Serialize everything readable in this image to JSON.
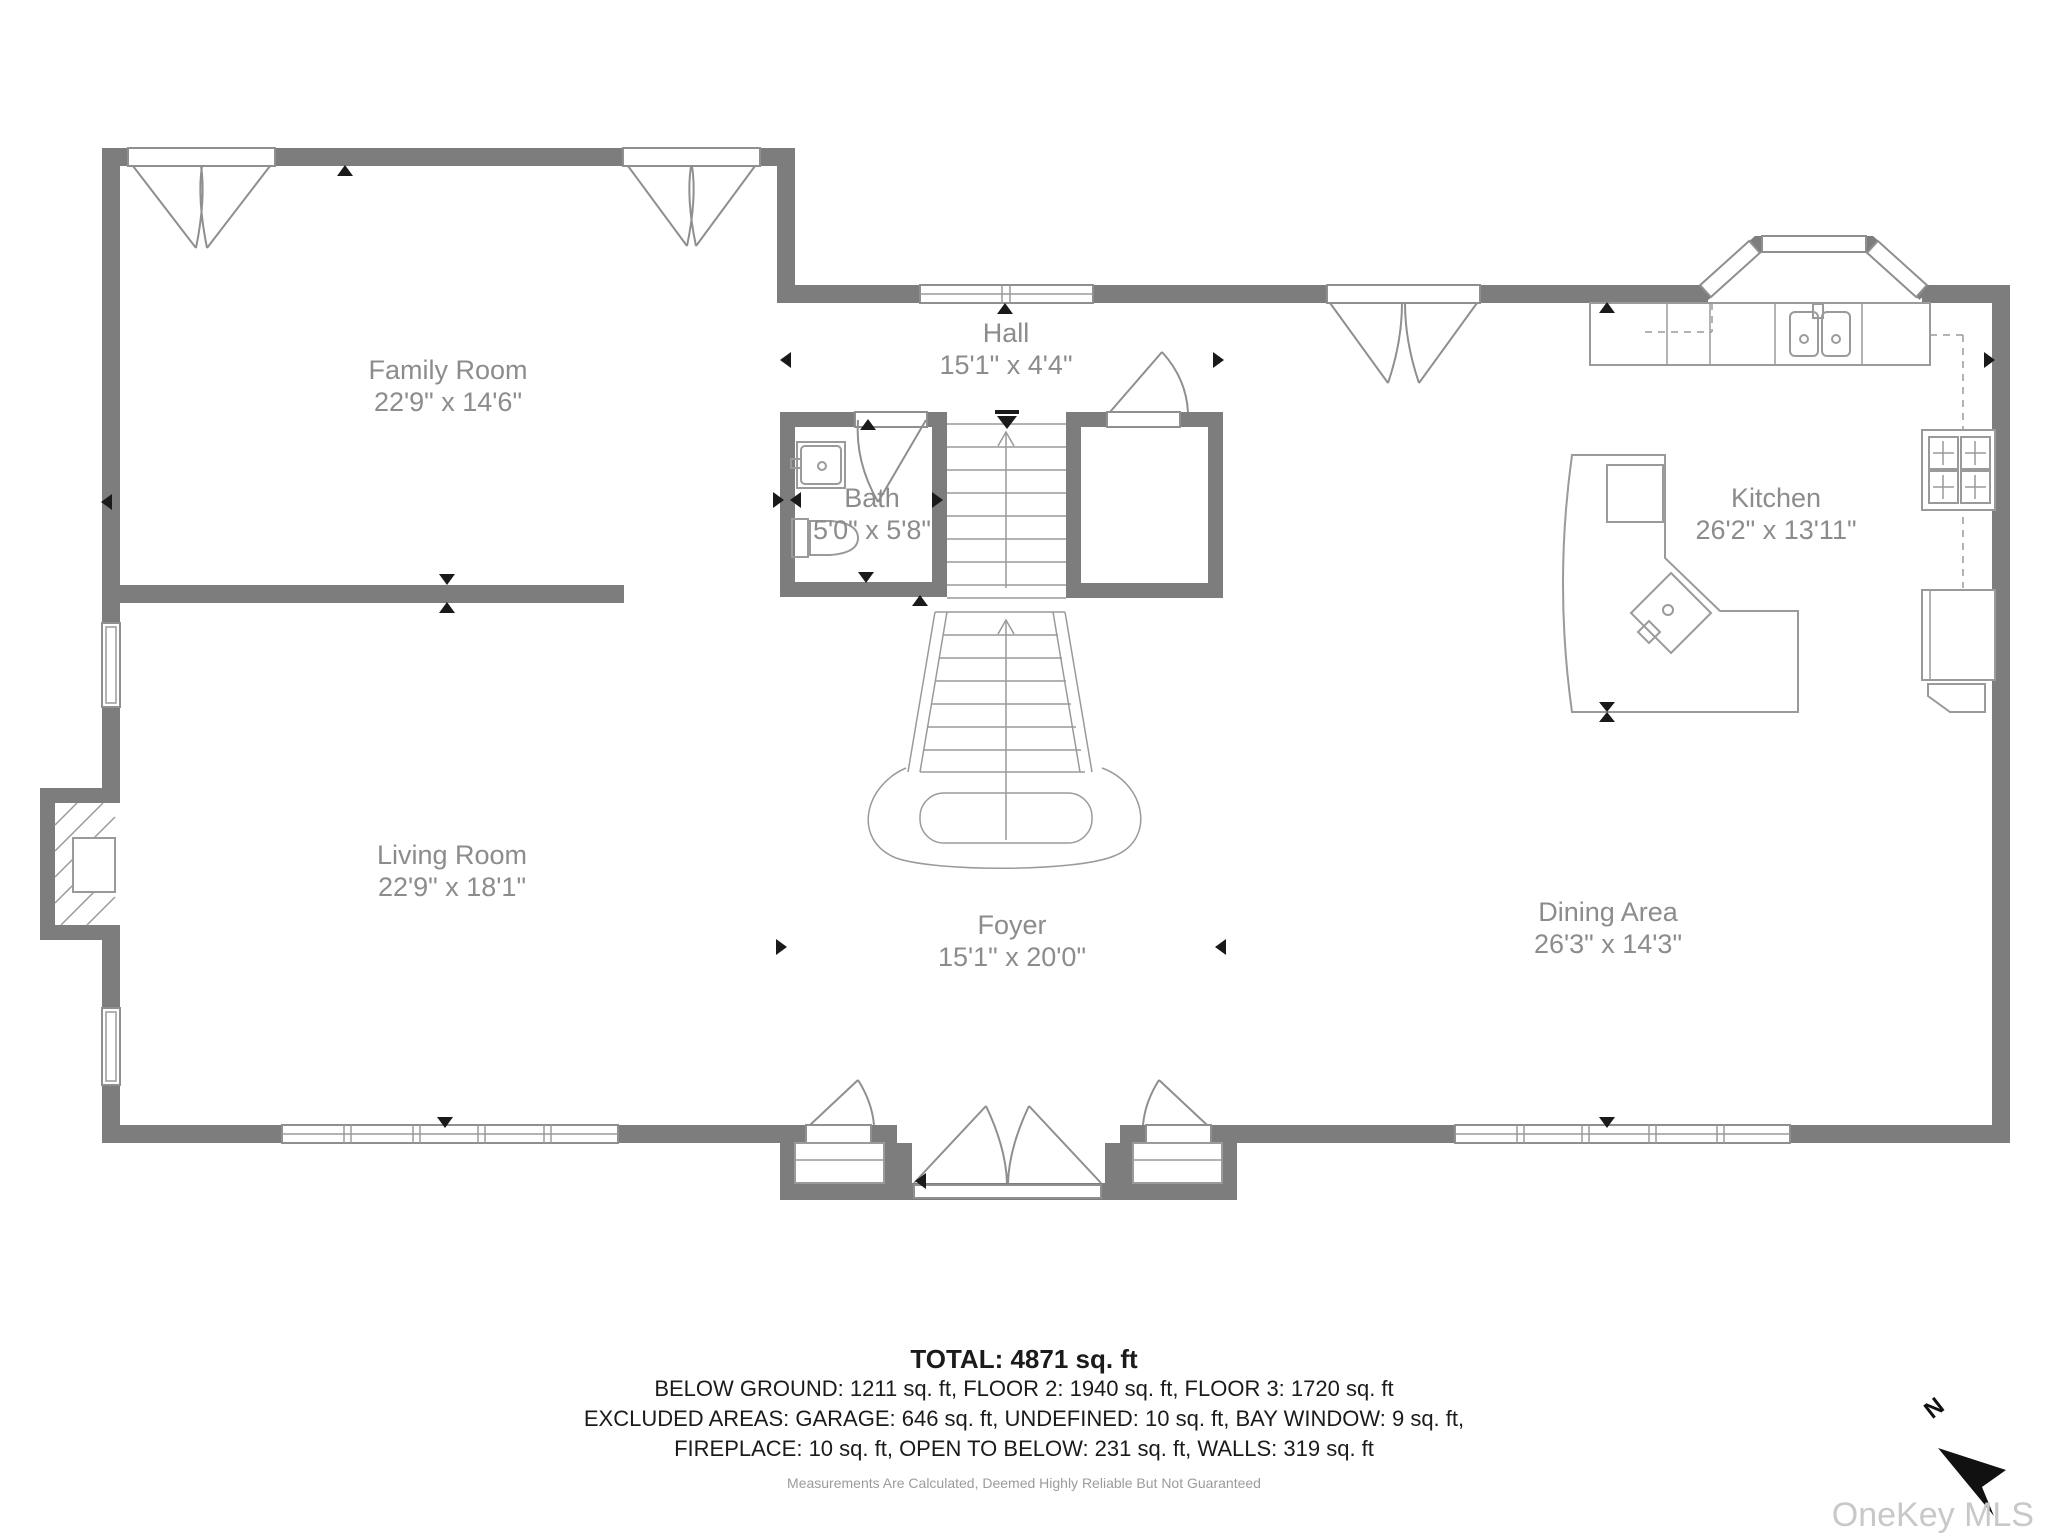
{
  "title": "First floor plan",
  "colors": {
    "wall": "#7d7d7d",
    "fixture_line": "#9a9a9a",
    "room_label": "#8c8c8c",
    "summary_text": "#1b1b1b",
    "note_text": "#9b9b9b",
    "watermark": "#c8c8c8",
    "marker": "#1a1a1a"
  },
  "rooms": [
    {
      "id": "family-room",
      "name": "Family Room",
      "dims": "22'9\" x 14'6\""
    },
    {
      "id": "hall",
      "name": "Hall",
      "dims": "15'1\" x 4'4\""
    },
    {
      "id": "bath",
      "name": "Bath",
      "dims": "5'0\" x 5'8\""
    },
    {
      "id": "kitchen",
      "name": "Kitchen",
      "dims": "26'2\" x 13'11\""
    },
    {
      "id": "living-room",
      "name": "Living Room",
      "dims": "22'9\" x 18'1\""
    },
    {
      "id": "foyer",
      "name": "Foyer",
      "dims": "15'1\" x 20'0\""
    },
    {
      "id": "dining-area",
      "name": "Dining Area",
      "dims": "26'3\" x 14'3\""
    }
  ],
  "summary": {
    "total": "TOTAL: 4871 sq. ft",
    "line2": "BELOW GROUND: 1211 sq. ft, FLOOR 2: 1940 sq. ft, FLOOR 3: 1720 sq. ft",
    "line3": "EXCLUDED AREAS: GARAGE: 646 sq. ft, UNDEFINED: 10 sq. ft, BAY WINDOW: 9 sq. ft,",
    "line4": "FIREPLACE: 10 sq. ft, OPEN TO BELOW: 231 sq. ft, WALLS: 319 sq. ft",
    "note": "Measurements Are Calculated, Deemed Highly Reliable But Not Guaranteed"
  },
  "watermark": "OneKey MLS",
  "compass": {
    "label": "N"
  }
}
